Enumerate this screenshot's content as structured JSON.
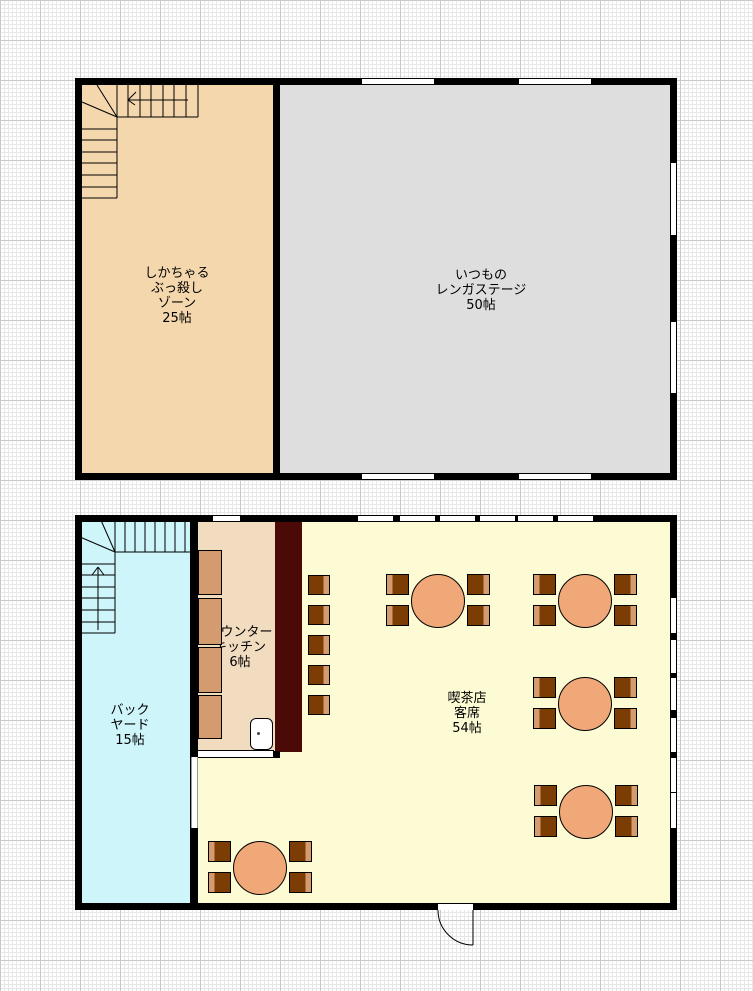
{
  "rooms": {
    "zone": {
      "lines": [
        "しかちゃる",
        "ぶっ殺し",
        "ゾーン",
        "25帖"
      ],
      "area": "25帖"
    },
    "stage": {
      "lines": [
        "いつもの",
        "レンガステージ",
        "50帖"
      ],
      "area": "50帖"
    },
    "backyard": {
      "lines": [
        "バック",
        "ヤード",
        "15帖"
      ],
      "area": "15帖"
    },
    "kitchen": {
      "lines": [
        "カウンター",
        "キッチン",
        "6帖"
      ],
      "area": "6帖"
    },
    "cafe": {
      "lines": [
        "喫茶店",
        "客席",
        "54帖"
      ],
      "area": "54帖"
    }
  },
  "colors": {
    "wall": "#000000",
    "zone": "#F4D7AD",
    "stage": "#DEDEDE",
    "backyard": "#CDF5FA",
    "kitchen": "#F2DCC0",
    "cafe": "#FDFBD4",
    "counter_bar": "#4B0A05",
    "counter_unit": "#D49C6E",
    "table": "#F0A878",
    "chair": "#7C3D05",
    "chair_strip": "#D49C6E"
  },
  "furniture": {
    "tables": [
      {
        "cx": 438,
        "cy": 601
      },
      {
        "cx": 585,
        "cy": 601
      },
      {
        "cx": 585,
        "cy": 704
      },
      {
        "cx": 586,
        "cy": 812
      },
      {
        "cx": 260,
        "cy": 868
      }
    ],
    "counter_seats": {
      "x": 308,
      "ys": [
        575,
        605,
        635,
        665,
        695
      ]
    },
    "counter_units": {
      "x": 198,
      "w": 24,
      "items": [
        [
          550,
          45
        ],
        [
          598,
          47
        ],
        [
          647,
          46
        ],
        [
          695,
          44
        ]
      ]
    }
  },
  "openings": {
    "upper_windows": [
      [
        362,
        79,
        72,
        5
      ],
      [
        519,
        79,
        72,
        5
      ],
      [
        362,
        474,
        72,
        5
      ],
      [
        519,
        474,
        72,
        5
      ],
      [
        671,
        163,
        5,
        72
      ],
      [
        671,
        322,
        5,
        71
      ]
    ],
    "lower_windows": [
      [
        213,
        516,
        27,
        5
      ],
      [
        358,
        516,
        35,
        5
      ],
      [
        400,
        516,
        35,
        5
      ],
      [
        440,
        516,
        35,
        5
      ],
      [
        480,
        516,
        35,
        5
      ],
      [
        518,
        516,
        35,
        5
      ],
      [
        558,
        516,
        35,
        5
      ],
      [
        671,
        598,
        5,
        35
      ],
      [
        671,
        640,
        5,
        33
      ],
      [
        671,
        678,
        5,
        32
      ],
      [
        671,
        718,
        5,
        34
      ],
      [
        671,
        758,
        5,
        34
      ],
      [
        671,
        793,
        5,
        35
      ]
    ],
    "entrance_opening": [
      438,
      904,
      35,
      6
    ],
    "backyard_door": [
      191,
      757,
      7,
      71
    ]
  }
}
